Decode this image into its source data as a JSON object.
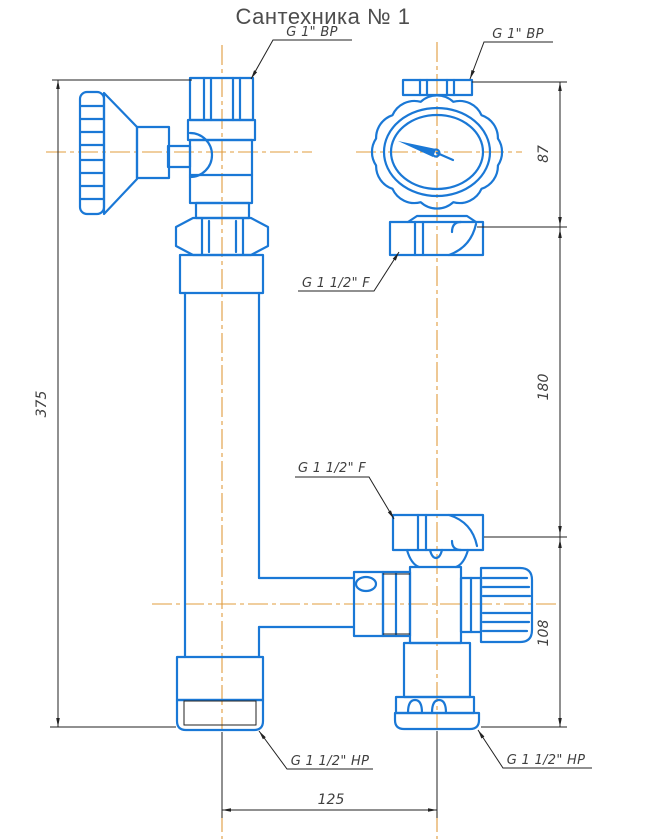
{
  "title": "Сантехника № 1",
  "colors": {
    "component": "#1a78d6",
    "centerline": "#e09c3e",
    "dimension": "#222222",
    "label": "#3f3f3f",
    "title": "#4d4d4d"
  },
  "labels": {
    "top_left_port": "G 1\" BP",
    "top_right_port": "G 1\" BP",
    "gauge_union": "G 1 1/2\" F",
    "valve_union": "G 1 1/2\" F",
    "bottom_left_port": "G 1 1/2\" HP",
    "bottom_right_port": "G 1 1/2\" HP"
  },
  "dimensions": {
    "total_height": "375",
    "gauge_height": "87",
    "middle_span": "180",
    "valve_height": "108",
    "bottom_width": "125"
  },
  "components": [
    "handwheel-valve",
    "supply-pipe-column",
    "pressure-gauge",
    "thermostatic-valve"
  ]
}
